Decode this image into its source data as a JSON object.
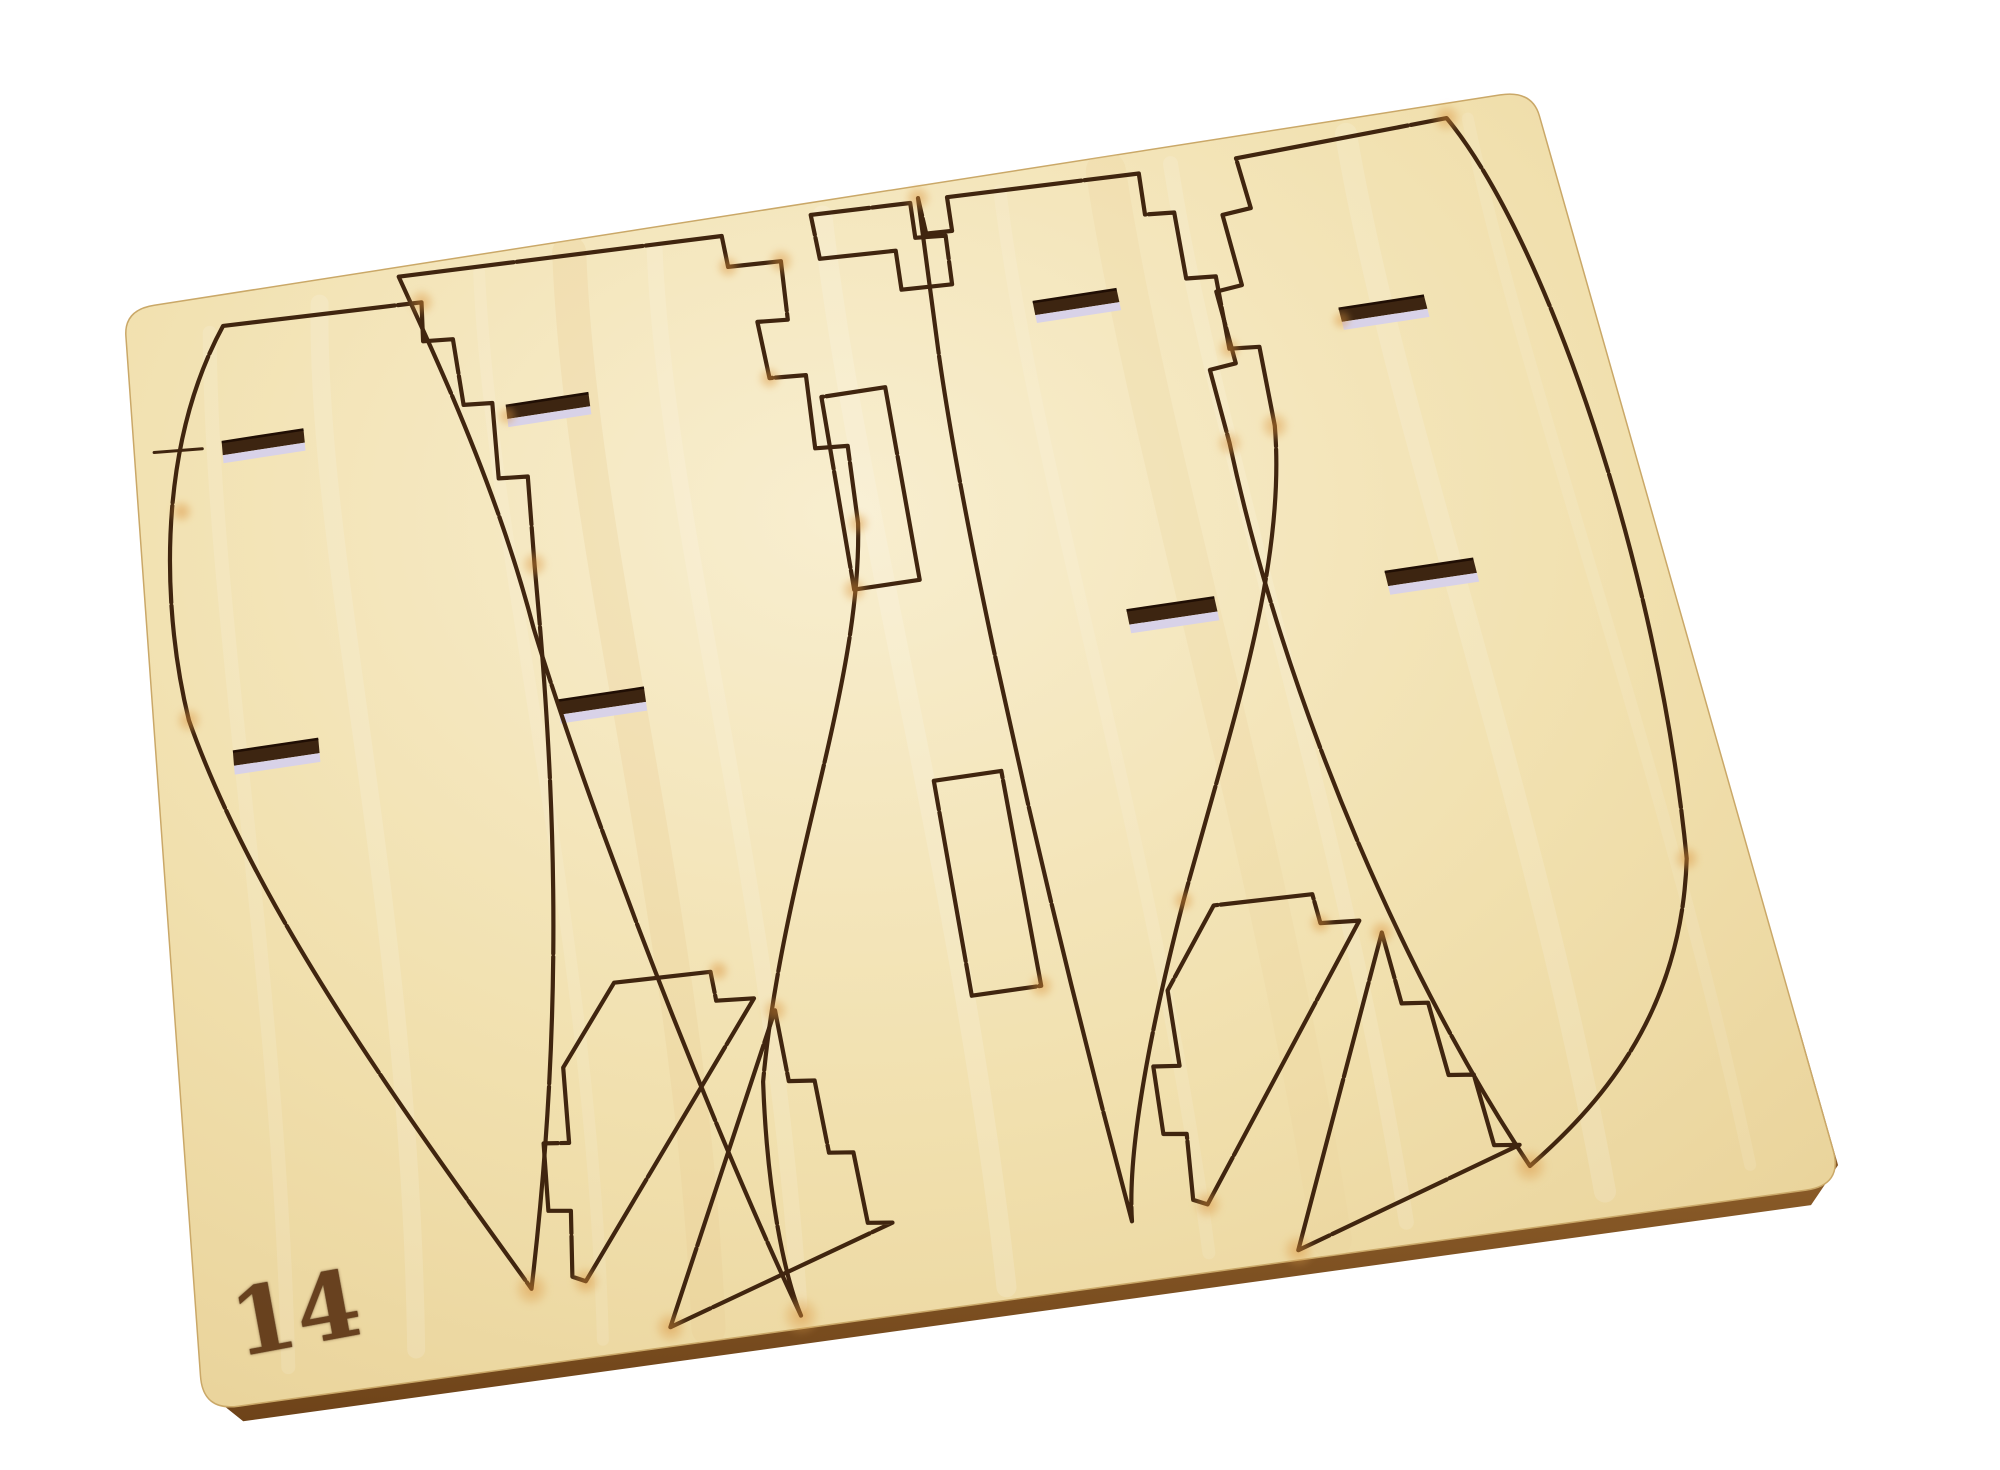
{
  "scene": {
    "description": "Photograph of a laser-cut plywood model ship kit sheet on a white background",
    "material": "birch plywood",
    "sheet": {
      "number": "14"
    },
    "inventory": {
      "hull_side_panels": 4,
      "keystone_filler_blocks": 2,
      "triangle_filler_blocks": 2,
      "keel_rectangles": 2,
      "notched_strip": 1,
      "through_slots": 8
    },
    "colors": {
      "background": "#ffffff",
      "wood_light": "#f8eecf",
      "wood_mid": "#f1e0ae",
      "wood_dark": "#e8d197",
      "cut_line": "#40250f",
      "burn_glow": "#d98a33",
      "slot_interior": "#3d2511",
      "slot_backing": "#d8d2e8",
      "edge_side": "#7c4e1f",
      "label": "#5d3514"
    }
  },
  "geometry": {
    "viewport": {
      "width": 2000,
      "height": 1470
    },
    "local_space": {
      "w": 1000,
      "h": 800
    },
    "homography": {
      "a": 1373.1,
      "b": 51.2,
      "c": 124,
      "d": -222.1,
      "e": 907.6,
      "f": 310,
      "g": -0.0228,
      "h": -0.1371
    },
    "sheet_outline": "M 22 0 L 978 0 Q 1000 0 1000 22 L 1000 778 Q 1000 800 978 800 L 22 800 Q 0 800 0 778 L 0 22 Q 0 0 22 0 Z",
    "edge_band": [
      [
        1000,
        688
      ],
      [
        1000,
        778
      ],
      [
        978,
        800
      ],
      [
        760,
        800
      ],
      [
        520,
        800
      ],
      [
        280,
        800
      ],
      [
        22,
        800
      ],
      [
        0,
        778
      ]
    ],
    "edge_offset": [
      5,
      15
    ],
    "cut_paths": [
      {
        "name": "hull-panel-a-outline",
        "d": "M 70 26 L 212 32 L 210 64 L 231 66 L 233 120 L 253 122 L 251 182 L 271 184 L 268 252 C 263 420 252 570 210 752 C 150 640 60 480 24 330 C 12 250 14 120 70 26 Z"
      },
      {
        "name": "hull-panel-b-outline",
        "d": "M 198 8 L 428 16 L 429 42 L 466 44 L 464 92 L 443 90 L 445 136 L 470 138 L 468 196 L 490 198 L 488 258 C 472 380 402 500 370 640 C 362 715 366 768 372 792 C 330 650 282 430 262 300 C 248 180 212 60 198 8 Z"
      },
      {
        "name": "notched-strip-outline",
        "d": "M 492 10 L 562 13 L 561 42 L 582 44 L 580 84 L 545 82 L 546 50 L 493 47 Z"
      },
      {
        "name": "keel-rectangle-1-outline",
        "d": "M 478 157 L 522 157 L 522 307 L 478 307 Z"
      },
      {
        "name": "keel-rectangle-2-outline",
        "d": "M 508 453 L 552 453 L 552 603 L 508 603 Z"
      },
      {
        "name": "hull-panel-c-outline",
        "d": "M 568 10 L 569 40 L 587 41 L 588 13 L 722 18 L 720 52 L 740 54 L 738 108 L 758 110 L 756 168 L 776 170 L 774 232 C 760 340 700 450 650 560 C 610 650 585 720 580 762 C 566 560 556 300 562 140 L 568 10 Z"
      },
      {
        "name": "hull-panel-d-outline",
        "d": "M 790 18 L 938 12 C 982 120 994 380 962 580 C 934 680 872 730 822 762 C 770 620 740 420 742 240 L 740 182 L 758 180 L 756 122 L 774 120 L 772 62 L 792 60 Z"
      },
      {
        "name": "keystone-block-1-outline",
        "d": "M 285 560 L 347 562 L 348 582 L 372 584 L 244 752 L 236 748 L 240 706 L 226 704 L 228 660 L 244 662 L 246 612 Z"
      },
      {
        "name": "triangle-block-1-outline",
        "d": "M 384 594 L 386 642 L 402 644 L 404 692 L 419 694 L 421 740 L 436 742 L 292 788 Z"
      },
      {
        "name": "keystone-block-2-outline",
        "d": "M 668 566 L 730 568 L 731 588 L 755 590 L 627 758 L 619 754 L 623 712 L 609 710 L 611 666 L 627 668 L 629 618 Z"
      },
      {
        "name": "triangle-block-2-outline",
        "d": "M 767 600 L 769 648 L 785 650 L 787 698 L 802 700 L 804 746 L 819 748 L 675 794 Z"
      }
    ],
    "score_lines": [
      {
        "name": "waterline-tick-a",
        "d": "M 14 120 L 48 123"
      }
    ],
    "slots": [
      {
        "name": "slot-a1",
        "x": 62,
        "y": 120,
        "w": 58,
        "h": 17
      },
      {
        "name": "slot-a2",
        "x": 52,
        "y": 358,
        "w": 58,
        "h": 17
      },
      {
        "name": "slot-b1",
        "x": 262,
        "y": 126,
        "w": 58,
        "h": 17
      },
      {
        "name": "slot-b2",
        "x": 272,
        "y": 356,
        "w": 58,
        "h": 17
      },
      {
        "name": "slot-c1",
        "x": 632,
        "y": 108,
        "w": 58,
        "h": 17
      },
      {
        "name": "slot-c2",
        "x": 652,
        "y": 352,
        "w": 58,
        "h": 17
      },
      {
        "name": "slot-d1",
        "x": 834,
        "y": 150,
        "w": 58,
        "h": 17
      },
      {
        "name": "slot-d2",
        "x": 822,
        "y": 352,
        "w": 58,
        "h": 17
      }
    ],
    "burn_marks": [
      [
        212,
        32,
        9
      ],
      [
        429,
        42,
        8
      ],
      [
        466,
        44,
        9
      ],
      [
        445,
        136,
        8
      ],
      [
        268,
        252,
        9
      ],
      [
        30,
        170,
        8
      ],
      [
        210,
        752,
        12
      ],
      [
        244,
        752,
        10
      ],
      [
        292,
        788,
        11
      ],
      [
        372,
        792,
        13
      ],
      [
        384,
        594,
        9
      ],
      [
        352,
        562,
        8
      ],
      [
        568,
        10,
        9
      ],
      [
        774,
        232,
        10
      ],
      [
        756,
        168,
        8
      ],
      [
        822,
        762,
        12
      ],
      [
        938,
        12,
        10
      ],
      [
        962,
        580,
        9
      ],
      [
        478,
        307,
        9
      ],
      [
        552,
        603,
        9
      ],
      [
        627,
        758,
        10
      ],
      [
        675,
        794,
        11
      ],
      [
        767,
        600,
        9
      ],
      [
        24,
        330,
        9
      ],
      [
        262,
        134,
        7
      ],
      [
        731,
        588,
        8
      ],
      [
        488,
        258,
        8
      ],
      [
        650,
        560,
        8
      ],
      [
        742,
        240,
        9
      ],
      [
        834,
        159,
        7
      ]
    ],
    "grain_streaks": [
      {
        "d": "M 60 30 C 45 250 70 520 55 780",
        "w": 14,
        "c": "#ffffff",
        "o": 0.12
      },
      {
        "d": "M 140 20 C 120 220 160 480 135 780",
        "w": 18,
        "c": "#ffffff",
        "o": 0.14
      },
      {
        "d": "M 255 15 C 240 240 275 520 250 790",
        "w": 12,
        "c": "#ffffff",
        "o": 0.11
      },
      {
        "d": "M 320 10 C 300 250 340 520 315 792",
        "w": 34,
        "c": "#e9cd92",
        "o": 0.28
      },
      {
        "d": "M 380 18 C 360 230 395 500 372 785",
        "w": 16,
        "c": "#ffffff",
        "o": 0.13
      },
      {
        "d": "M 500 12 C 488 250 515 520 498 792",
        "w": 20,
        "c": "#ffffff",
        "o": 0.15
      },
      {
        "d": "M 625 15 C 610 240 640 510 622 788",
        "w": 13,
        "c": "#ffffff",
        "o": 0.11
      },
      {
        "d": "M 700 12 C 688 240 712 520 696 790",
        "w": 40,
        "c": "#ecd29b",
        "o": 0.25
      },
      {
        "d": "M 745 14 C 732 230 760 500 742 786",
        "w": 15,
        "c": "#ffffff",
        "o": 0.13
      },
      {
        "d": "M 868 12 C 852 240 880 520 862 784",
        "w": 22,
        "c": "#ffffff",
        "o": 0.14
      },
      {
        "d": "M 952 15 C 940 230 965 500 950 780",
        "w": 12,
        "c": "#ffffff",
        "o": 0.1
      }
    ],
    "label": {
      "x": 224,
      "y": 1280,
      "rotation_deg": -10.5,
      "font_size": 92
    }
  }
}
